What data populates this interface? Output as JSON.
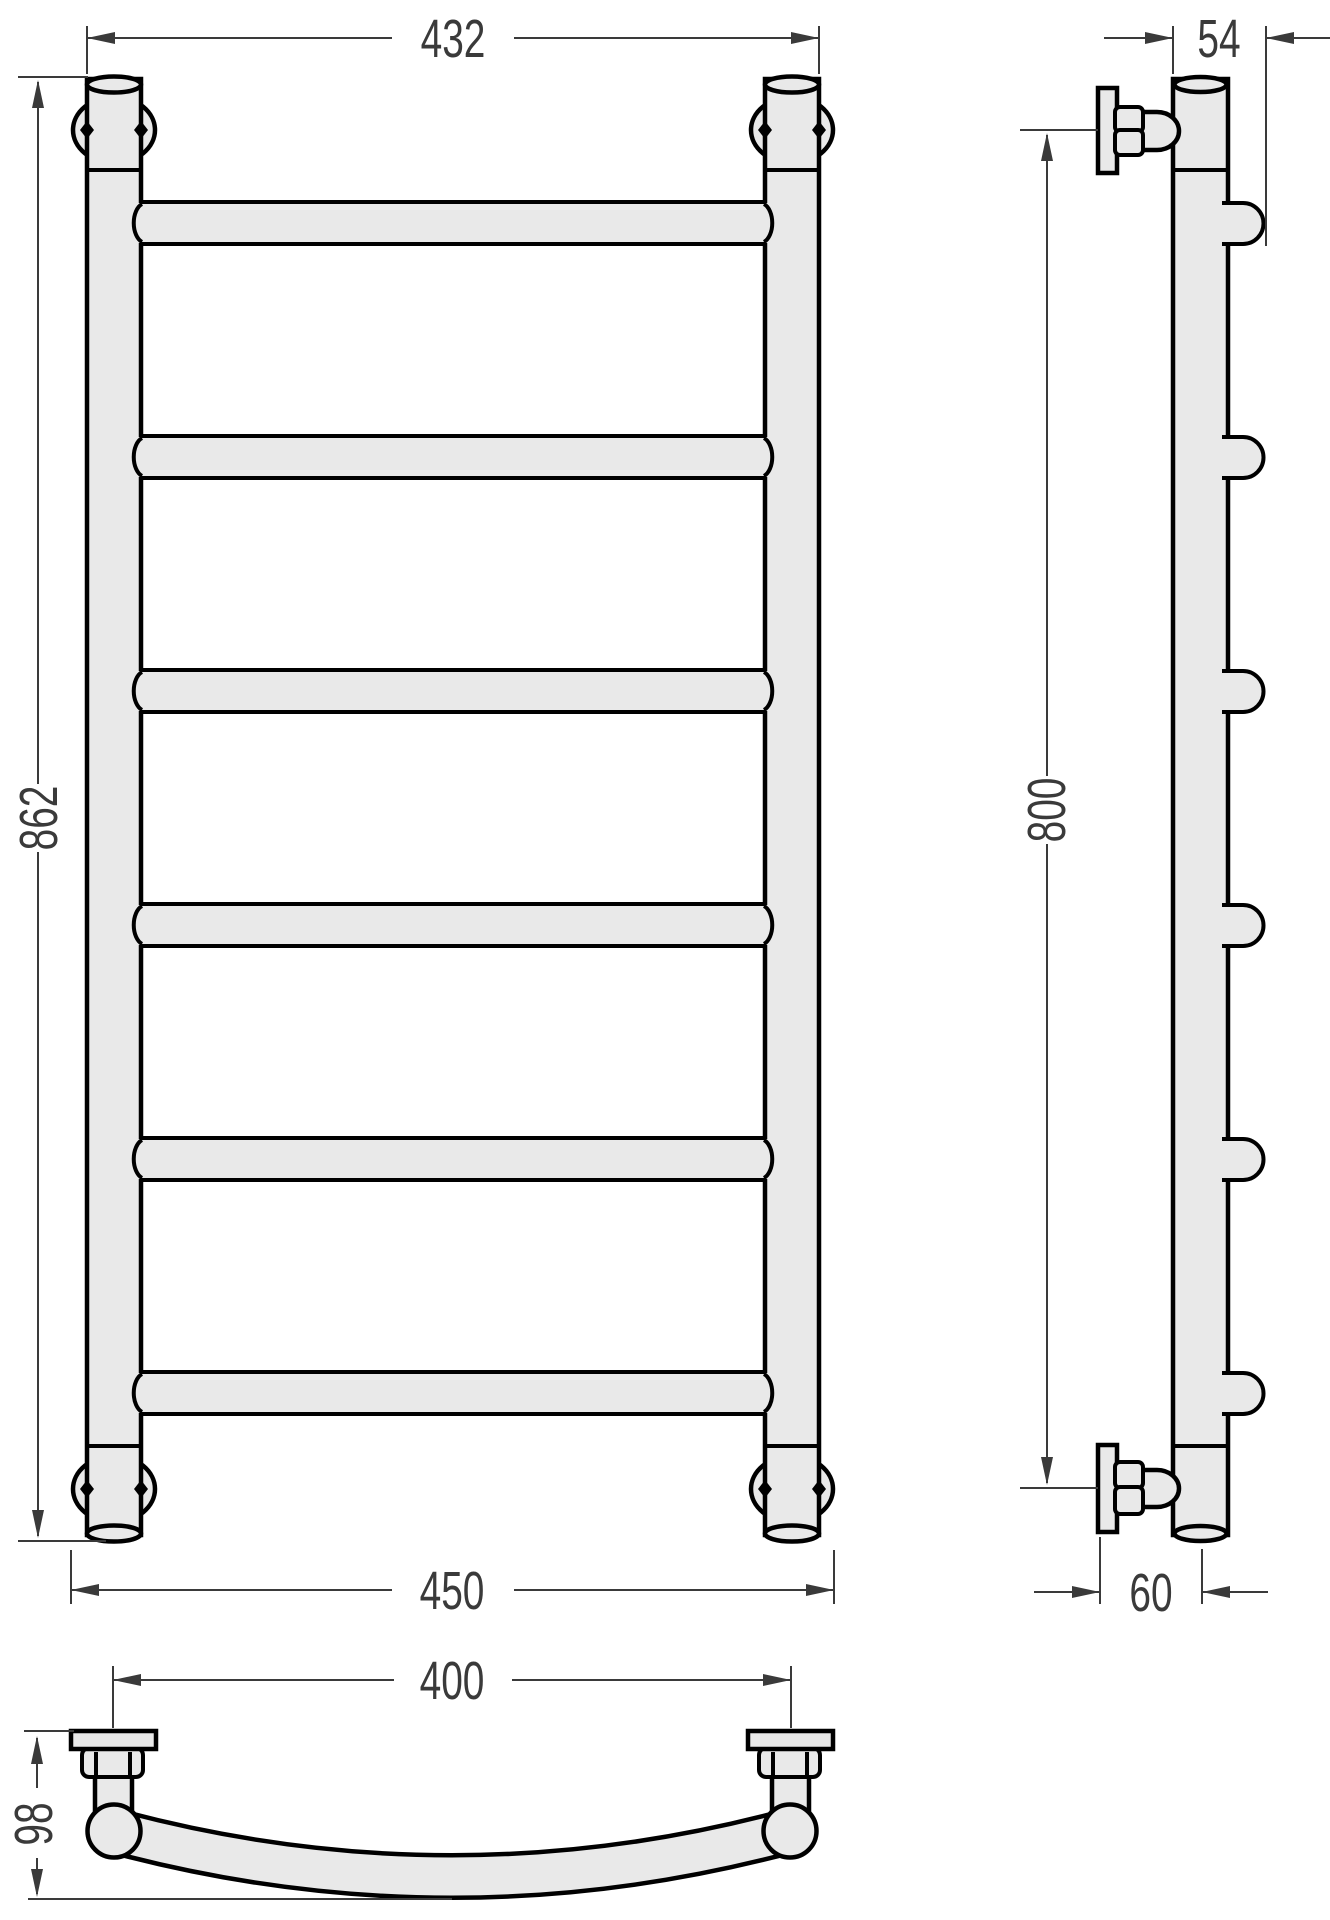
{
  "drawing": {
    "type": "technical-dimension-drawing",
    "subject": "ladder-style heated towel rail, three orthographic views",
    "dimensions": {
      "front_top_width": "432",
      "front_height": "862",
      "front_bottom_width": "450",
      "side_top_depth": "54",
      "side_mount_height": "800",
      "side_bottom_depth": "60",
      "plan_mount_span": "400",
      "plan_depth": "98"
    },
    "style": {
      "background": "#ffffff",
      "part_fill": "#e9e9e9",
      "outline_color": "#000000",
      "dimension_color": "#3a3a3a"
    }
  }
}
